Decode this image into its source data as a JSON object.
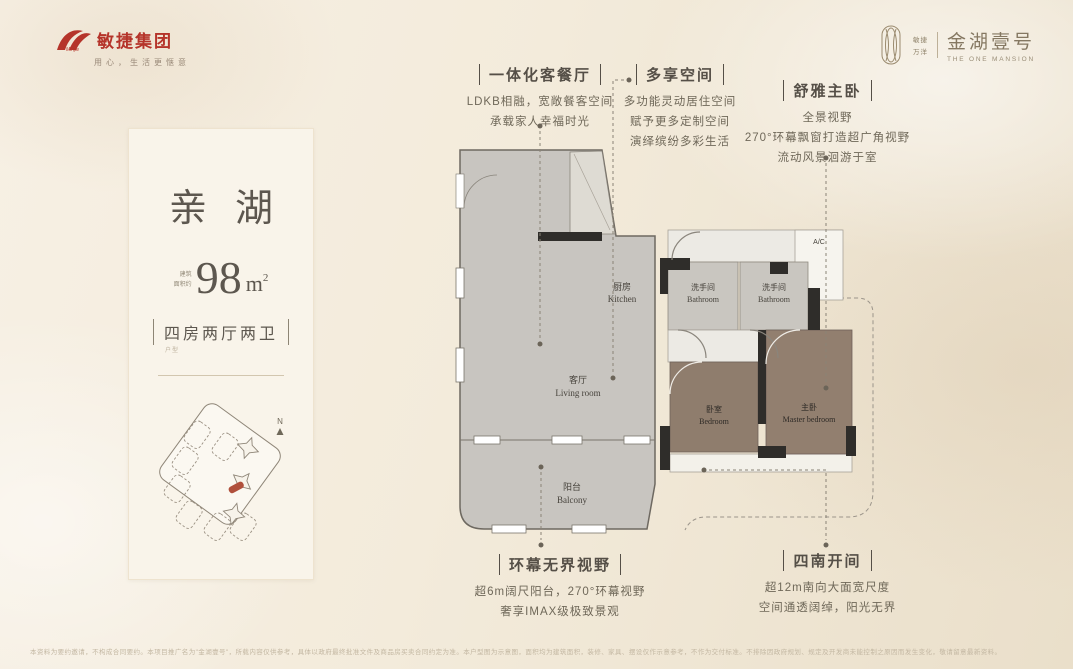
{
  "brand": {
    "group_name": "敏捷集团",
    "group_latin": "Minjie",
    "slogan": "用心，生活更惬意",
    "accent_red": "#b5342a"
  },
  "project": {
    "co_brand_top": "敏捷",
    "co_brand_bottom": "万洋",
    "name": "金湖壹号",
    "name_en": "THE ONE MANSION",
    "gold": "#8d8068"
  },
  "card": {
    "title": "亲湖",
    "area_prefix_1": "建筑",
    "area_prefix_2": "面积约",
    "area_value": "98",
    "area_unit": "m",
    "area_sup": "2",
    "layout": "四房两厅两卫",
    "layout_note": "户型",
    "compass": "N"
  },
  "annotations": {
    "unified_living": {
      "title": "一体化客餐厅",
      "lines": [
        "LDKB相融，宽敞餐客空间",
        "承载家人幸福时光"
      ]
    },
    "multi_space": {
      "title": "多享空间",
      "lines": [
        "多功能灵动居住空间",
        "赋予更多定制空间",
        "演绎缤纷多彩生活"
      ]
    },
    "master_suite": {
      "title": "舒雅主卧",
      "lines": [
        "全景视野",
        "270°环幕飘窗打造超广角视野",
        "流动风景洄游于室"
      ]
    },
    "panoramic_view": {
      "title": "环幕无界视野",
      "lines": [
        "超6m阔尺阳台，270°环幕视野",
        "奢享IMAX级极致景观"
      ]
    },
    "south_bays": {
      "title": "四南开间",
      "lines": [
        "超12m南向大面宽尺度",
        "空间通透阔绰，阳光无界"
      ]
    }
  },
  "floorplan": {
    "rooms": {
      "kitchen": {
        "zh": "厨房",
        "en": "Kitchen"
      },
      "living": {
        "zh": "客厅",
        "en": "Living room"
      },
      "balcony": {
        "zh": "阳台",
        "en": "Balcony"
      },
      "bath1": {
        "zh": "洗手间",
        "en": "Bathroom"
      },
      "bath2": {
        "zh": "洗手间",
        "en": "Bathroom"
      },
      "bedroom": {
        "zh": "卧室",
        "en": "Bedroom"
      },
      "master": {
        "zh": "主卧",
        "en": "Master bedroom"
      },
      "ac": "A/C"
    }
  },
  "footer": {
    "disclaimer": "本资料为要约邀请，不构成合同要约。本项目推广名为\"金湖壹号\"，所载内容仅供参考，具体以政府最终批准文件及商品房买卖合同约定为准。本户型图为示意图，面积均为建筑面积，装修、家具、摆设仅作示意参考，不作为交付标准。不排除因政府规划、规定及开发商未能控制之原因而发生变化，敬请留意最新资料。"
  }
}
